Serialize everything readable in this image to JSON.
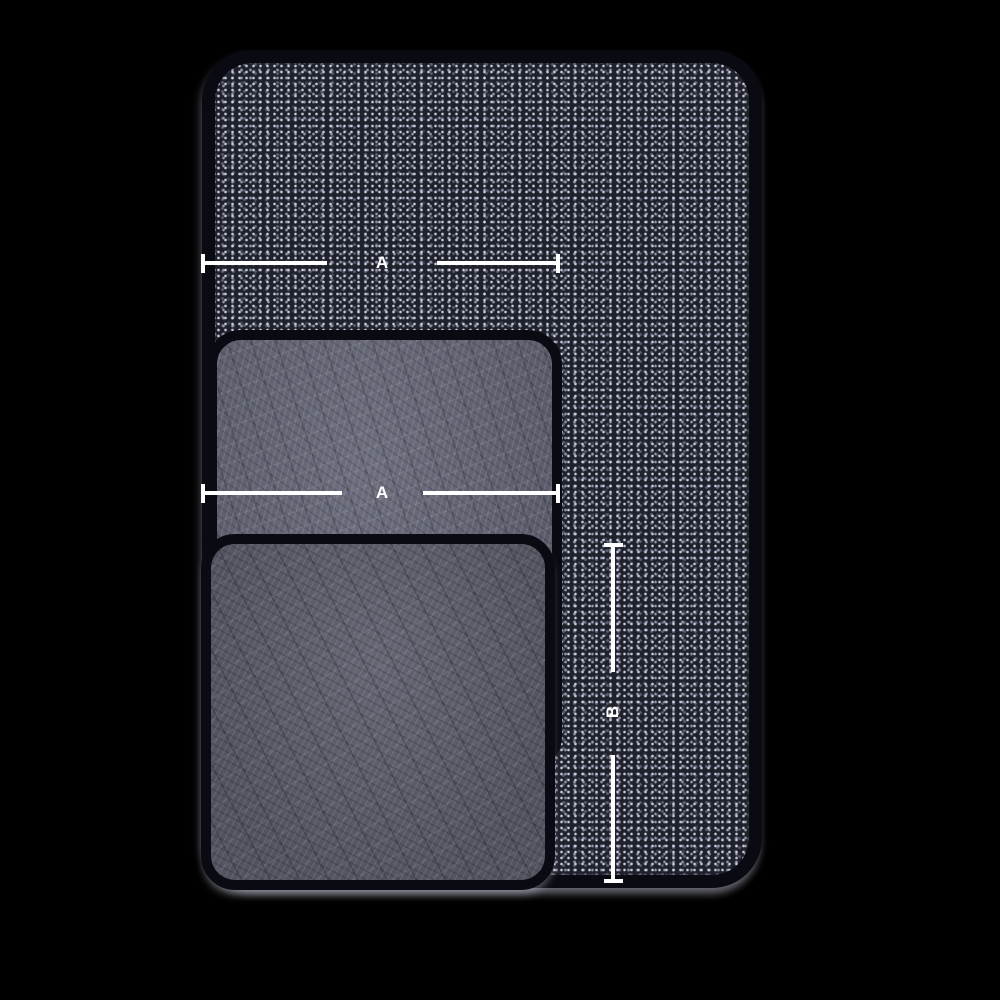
{
  "diagram": {
    "labels": {
      "top_width": "A",
      "middle_width": "A",
      "side_height": "B"
    },
    "colors": {
      "background": "#000000",
      "mat_binding": "#0a0b12",
      "large_mat_base": "#1f212b",
      "large_mat_speckle": "#aeb3c7",
      "medium_mat_base": "#646676",
      "small_mat_base": "#5c5e6b",
      "dimension_line": "#ffffff"
    }
  }
}
